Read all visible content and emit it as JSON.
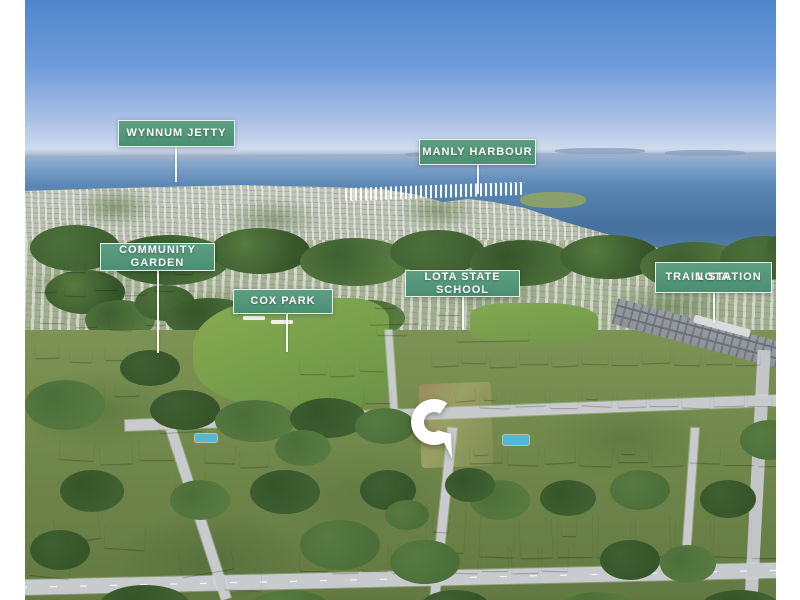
{
  "annotations": {
    "wynnum_jetty": {
      "text": "WYNNUM JETTY"
    },
    "manly_harbour": {
      "text": "MANLY HARBOUR"
    },
    "community_garden": {
      "text": "COMMUNITY GARDEN"
    },
    "cox_park": {
      "text": "COX PARK"
    },
    "lota_state_school": {
      "text": "LOTA STATE SCHOOL"
    },
    "lota_train_station": {
      "line1": "LOTA",
      "line2": "TRAIN STATION"
    }
  },
  "pin": {
    "icon": "c-logo-location-pin",
    "color": "#ffffff"
  },
  "colors": {
    "label_background": "#4b8f72",
    "label_background_light": "#5d9e82",
    "label_border": "#e3f2ea",
    "label_text": "#ffffff"
  }
}
